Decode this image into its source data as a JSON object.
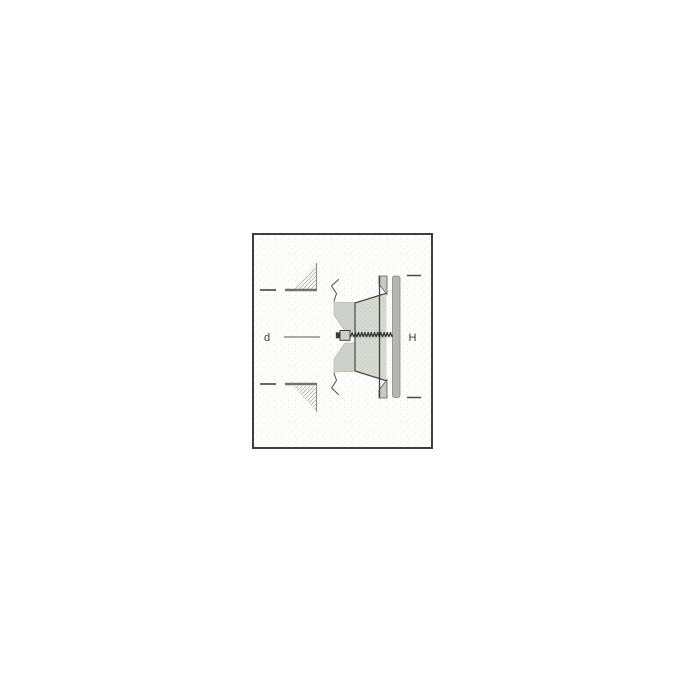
{
  "figure": {
    "kind": "technical-section-diagram",
    "subject": "disc-valve-in-duct-cross-section",
    "labels": {
      "diameter": "d",
      "height": "H"
    },
    "colors": {
      "page_background": "#ffffff",
      "frame_background": "#fdfffd",
      "frame_border": "#3e3e3e",
      "dot_pattern": "#dde8dc",
      "outline": "#4a4a4a",
      "wall_line": "#6f736d",
      "hatch_line": "#a0a69e",
      "label_color": "#3a3a3a",
      "cone_fill": "#d5d9d1",
      "gasket_fill": "#ccd2ca",
      "disc_fill": "#b3b7b1",
      "flange_fill": "#c6cac2",
      "nut_fill": "#cbcfc7",
      "thread_color": "#1e1e1e"
    }
  }
}
